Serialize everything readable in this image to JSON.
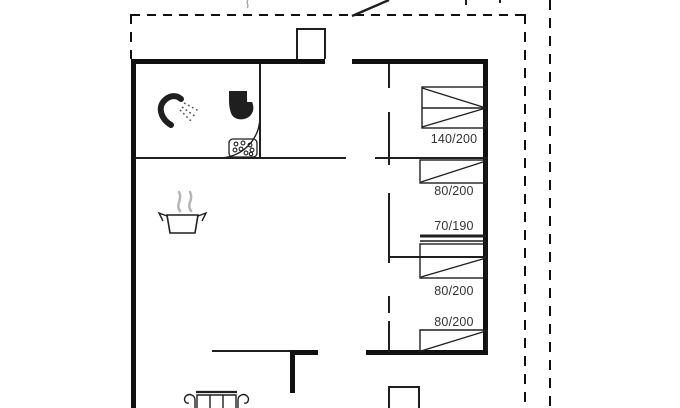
{
  "floorplan": {
    "colors": {
      "wall": "#111111",
      "line": "#1f1f1f",
      "label": "#333333",
      "steam": "#b5b5b5"
    },
    "bed_labels": [
      {
        "name": "double-bed",
        "size": "140/200"
      },
      {
        "name": "single-bed-1",
        "size": "80/200"
      },
      {
        "name": "bunk-bed-top",
        "size": "70/190"
      },
      {
        "name": "bunk-bed-bottom",
        "size": "80/200"
      },
      {
        "name": "single-bed-2",
        "size": "80/200"
      }
    ],
    "icons": [
      "shower-icon",
      "toilet-icon",
      "shower-tray-icon",
      "cooking-pot-icon",
      "sofa-icon"
    ]
  }
}
